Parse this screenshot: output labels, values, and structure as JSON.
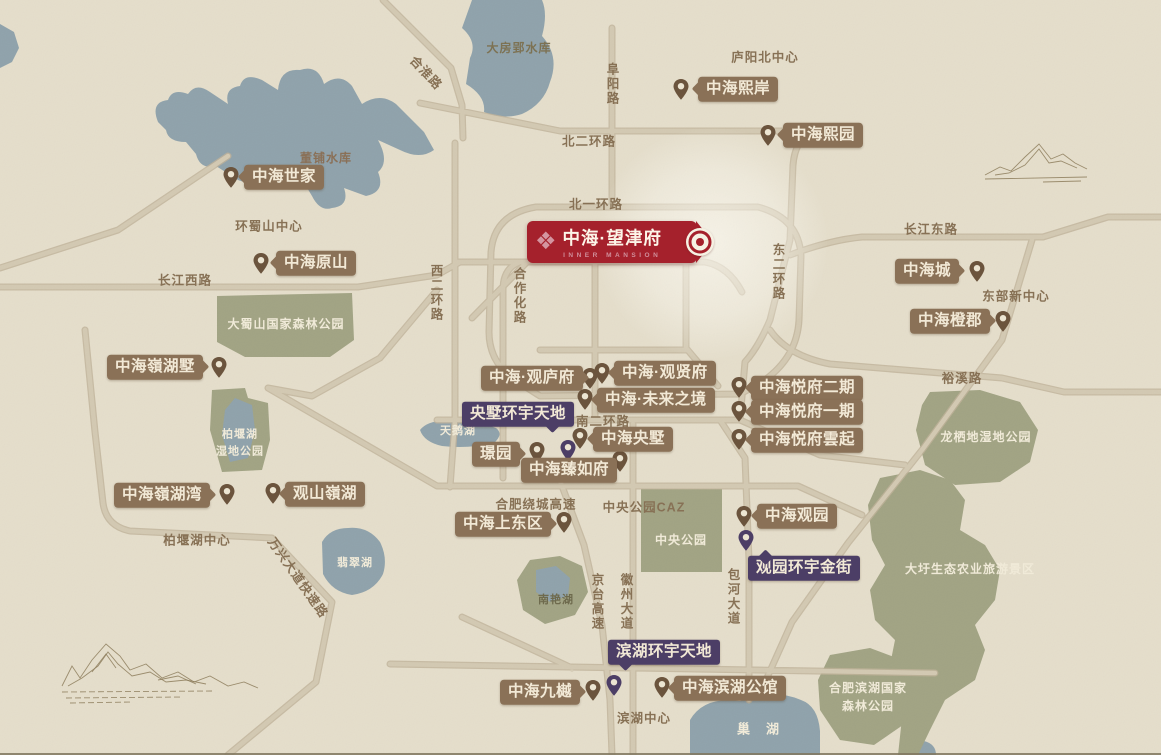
{
  "banner": {
    "logo": "❖",
    "title": "中海·望津府",
    "subtitle": "INNER MANSION"
  },
  "colors": {
    "background": "#e5decb",
    "water": "#8fa2ab",
    "park": "#a1a383",
    "road": "#d3c9b2",
    "label_brown": "#8a7157",
    "label_purple": "#4c3e66",
    "banner_red": "#a5212c",
    "pin_brown": "#6b543d",
    "pin_purple": "#4c3e66",
    "road_text": "#877155"
  },
  "projects": [
    {
      "text": "中海世家",
      "x": 244,
      "y": 177,
      "arrow": "left",
      "px": 231,
      "py": 189
    },
    {
      "text": "中海熙岸",
      "x": 698,
      "y": 89,
      "arrow": "left",
      "px": 681,
      "py": 101
    },
    {
      "text": "中海熙园",
      "x": 783,
      "y": 135,
      "arrow": "left",
      "px": 768,
      "py": 147
    },
    {
      "text": "中海原山",
      "x": 276,
      "y": 263,
      "arrow": "left",
      "px": 261,
      "py": 275
    },
    {
      "text": "中海城",
      "x": 895,
      "y": 271,
      "arrow": "right",
      "px": 977,
      "py": 283
    },
    {
      "text": "中海橙郡",
      "x": 910,
      "y": 321,
      "arrow": "right",
      "px": 1003,
      "py": 333
    },
    {
      "text": "中海嶺湖墅",
      "x": 107,
      "y": 367,
      "arrow": "right",
      "px": 219,
      "py": 379
    },
    {
      "text": "中海·观庐府",
      "x": 481,
      "y": 378,
      "arrow": "right",
      "px": 590,
      "py": 390
    },
    {
      "text": "中海·观贤府",
      "x": 614,
      "y": 373,
      "arrow": "left",
      "px": 602,
      "py": 385
    },
    {
      "text": "中海·未来之境",
      "x": 597,
      "y": 400,
      "arrow": "left",
      "px": 585,
      "py": 411
    },
    {
      "text": "中海央墅",
      "x": 593,
      "y": 439,
      "arrow": "left",
      "px": 580,
      "py": 450
    },
    {
      "text": "中海悦府二期",
      "x": 751,
      "y": 388,
      "arrow": "left",
      "px": 739,
      "py": 399
    },
    {
      "text": "中海悦府一期",
      "x": 751,
      "y": 412,
      "arrow": "left",
      "px": 739,
      "py": 423
    },
    {
      "text": "中海悦府雲起",
      "x": 751,
      "y": 440,
      "arrow": "left",
      "px": 739,
      "py": 451
    },
    {
      "text": "璟园",
      "x": 472,
      "y": 454,
      "arrow": "right",
      "px": 537,
      "py": 464
    },
    {
      "text": "中海臻如府",
      "x": 521,
      "y": 470,
      "arrow": "none",
      "px": 620,
      "py": 473
    },
    {
      "text": "中海嶺湖湾",
      "x": 114,
      "y": 495,
      "arrow": "right",
      "px": 227,
      "py": 506
    },
    {
      "text": "观山嶺湖",
      "x": 285,
      "y": 494,
      "arrow": "left",
      "px": 273,
      "py": 505
    },
    {
      "text": "中海上东区",
      "x": 455,
      "y": 524,
      "arrow": "right",
      "px": 564,
      "py": 534
    },
    {
      "text": "中海观园",
      "x": 757,
      "y": 516,
      "arrow": "left",
      "px": 744,
      "py": 528
    },
    {
      "text": "中海九樾",
      "x": 500,
      "y": 692,
      "arrow": "right",
      "px": 593,
      "py": 702
    },
    {
      "text": "中海滨湖公馆",
      "x": 674,
      "y": 688,
      "arrow": "left",
      "px": 662,
      "py": 699
    }
  ],
  "landmarks": [
    {
      "text": "央墅环宇天地",
      "x": 462,
      "y": 414,
      "tail": "br",
      "px": 568,
      "py": 462
    },
    {
      "text": "观园环宇金街",
      "x": 748,
      "y": 568,
      "tail": "tl",
      "px": 746,
      "py": 552
    },
    {
      "text": "滨湖环宇天地",
      "x": 608,
      "y": 652,
      "tail": "bl",
      "px": 614,
      "py": 697
    }
  ],
  "road_labels": [
    {
      "text": "合淮路",
      "x": 427,
      "y": 72,
      "o": "d",
      "a": 47
    },
    {
      "text": "阜阳路",
      "x": 612,
      "y": 84,
      "o": "v"
    },
    {
      "text": "北二环路",
      "x": 589,
      "y": 140,
      "o": "h"
    },
    {
      "text": "北一环路",
      "x": 596,
      "y": 203,
      "o": "h"
    },
    {
      "text": "长江东路",
      "x": 931,
      "y": 228,
      "o": "h"
    },
    {
      "text": "长江西路",
      "x": 185,
      "y": 279,
      "o": "h"
    },
    {
      "text": "东二环路",
      "x": 778,
      "y": 272,
      "o": "v"
    },
    {
      "text": "西二环路",
      "x": 436,
      "y": 293,
      "o": "v"
    },
    {
      "text": "合作化路",
      "x": 519,
      "y": 296,
      "o": "v"
    },
    {
      "text": "南二环路",
      "x": 603,
      "y": 420,
      "o": "h"
    },
    {
      "text": "裕溪路",
      "x": 962,
      "y": 377,
      "o": "h"
    },
    {
      "text": "合肥绕城高速",
      "x": 536,
      "y": 503,
      "o": "h"
    },
    {
      "text": "万兴大道快速路",
      "x": 299,
      "y": 577,
      "o": "d",
      "a": 55
    },
    {
      "text": "京台高速",
      "x": 597,
      "y": 602,
      "o": "v"
    },
    {
      "text": "徽州大道",
      "x": 626,
      "y": 602,
      "o": "v"
    },
    {
      "text": "包河大道",
      "x": 733,
      "y": 597,
      "o": "v"
    }
  ],
  "district_labels": [
    {
      "text": "庐阳北中心",
      "x": 765,
      "y": 56
    },
    {
      "text": "环蜀山中心",
      "x": 269,
      "y": 225
    },
    {
      "text": "东部新中心",
      "x": 1016,
      "y": 295
    },
    {
      "text": "中央公园CAZ",
      "x": 644,
      "y": 506
    },
    {
      "text": "柏堰湖中心",
      "x": 197,
      "y": 539
    },
    {
      "text": "滨湖中心",
      "x": 644,
      "y": 717
    }
  ],
  "area_labels": [
    {
      "text": "大房郢水库",
      "x": 519,
      "y": 48,
      "o": "v",
      "color": "#7d7253",
      "size": 12
    },
    {
      "text": "董铺水库",
      "x": 326,
      "y": 158,
      "color": "#8a7057",
      "size": 12
    },
    {
      "text": "天鹅湖",
      "x": 458,
      "y": 431,
      "color": "#f0ead8",
      "size": 11
    },
    {
      "text": "大蜀山国家森林公园",
      "x": 286,
      "y": 324,
      "color": "#f0ead8",
      "size": 12
    },
    {
      "text": "柏堰湖\n湿地公园",
      "x": 240,
      "y": 443,
      "color": "#f0ead8",
      "size": 11
    },
    {
      "text": "翡翠湖",
      "x": 355,
      "y": 563,
      "color": "#f0ead8",
      "size": 11
    },
    {
      "text": "南艳湖",
      "x": 556,
      "y": 600,
      "color": "#6e6a4d",
      "size": 11
    },
    {
      "text": "中央公园",
      "x": 681,
      "y": 540,
      "color": "#f0ead8",
      "size": 12
    },
    {
      "text": "龙栖地湿地公园",
      "x": 986,
      "y": 437,
      "color": "#f0ead8",
      "size": 12
    },
    {
      "text": "大圩生态农业旅游景区",
      "x": 970,
      "y": 569,
      "color": "#f0ead8",
      "size": 12
    },
    {
      "text": "合肥滨湖国家\n森林公园",
      "x": 868,
      "y": 697,
      "color": "#f0ead8",
      "size": 12
    },
    {
      "text": "巢湖",
      "x": 766,
      "y": 729,
      "color": "#f0ead8",
      "size": 13,
      "ls": 16
    }
  ]
}
